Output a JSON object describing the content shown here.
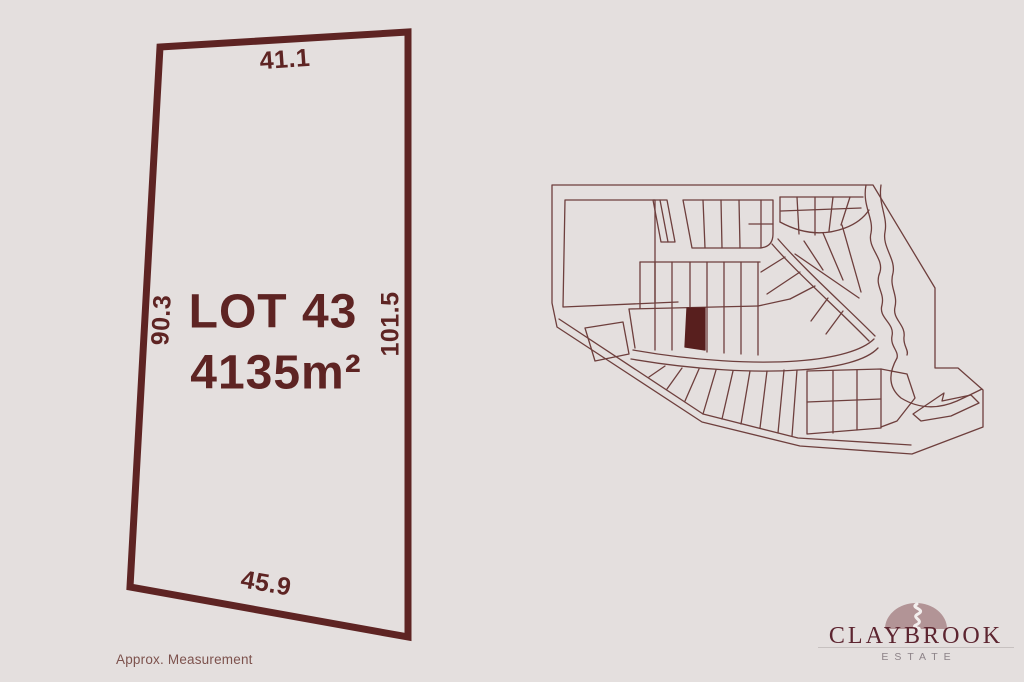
{
  "lot_plan": {
    "lot_label": "LOT 43",
    "area": "4135m²",
    "dimensions": {
      "top": "41.1",
      "left": "90.3",
      "right": "101.5",
      "bottom": "45.9"
    },
    "footnote": "Approx. Measurement"
  },
  "estate_map": {
    "description": "subdivision overview map",
    "highlighted_lot": "LOT 43"
  },
  "logo": {
    "name": "CLAYBROOK",
    "subtitle": "ESTATE",
    "mark": "brook-dome-icon"
  },
  "colors": {
    "background": "#e4dfde",
    "outline": "#5e2423",
    "map_line": "#6e3f3d",
    "highlight": "#581f1e",
    "footnote_text": "#7d524d",
    "logo_text": "#5d2530",
    "logo_dome": "#b29496",
    "logo_subtitle": "#8c8287"
  }
}
